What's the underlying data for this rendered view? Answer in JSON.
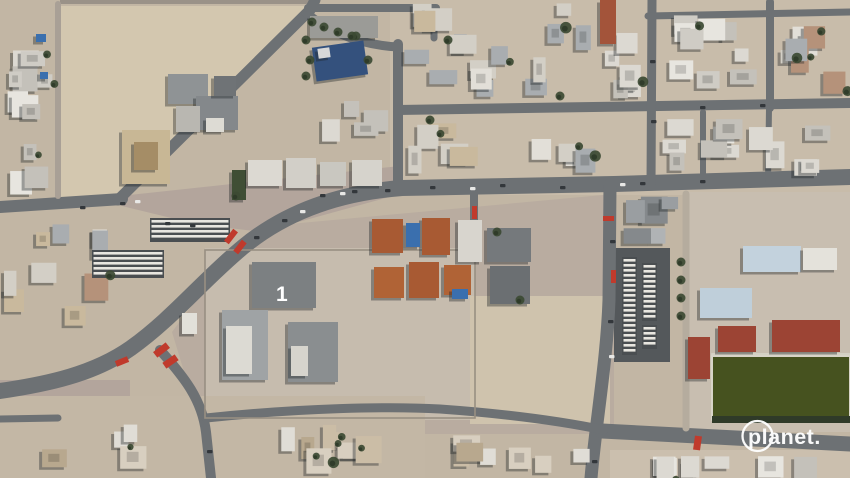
{
  "watermark": {
    "text": "planet."
  },
  "scene": {
    "labels": {
      "compound_number": "1"
    },
    "colors": {
      "base": "#c2b6a4",
      "sand_lot": "#d3c7af",
      "pink_pave": "#b3a59c",
      "pave_light": "#c6bcae",
      "road": "#6d7174",
      "asphalt": "#54585b",
      "field_green": "#46521f",
      "tree": "#3c4a33",
      "red_mark": "#c03a2c",
      "navy_roof": "#34517d",
      "pool_blue": "#3a6fae",
      "school_blue": "#c3d2dd",
      "school_red": "#9c4434",
      "white": "#ffffff"
    },
    "grounds": [
      {
        "type": "rect",
        "x": 0,
        "y": 0,
        "w": 850,
        "h": 478,
        "f": "#c2b6a4"
      },
      {
        "type": "rect",
        "x": 390,
        "y": 0,
        "w": 460,
        "h": 195,
        "f": "#c8bcaa"
      },
      {
        "type": "poly",
        "pts": [
          [
            57,
            6
          ],
          [
            308,
            6
          ],
          [
            300,
            16
          ],
          [
            118,
            197
          ],
          [
            57,
            197
          ]
        ],
        "f": "#d3c7af"
      },
      {
        "type": "poly",
        "pts": [
          [
            120,
            196
          ],
          [
            400,
            166
          ],
          [
            400,
            194
          ],
          [
            262,
            232
          ],
          [
            196,
            224
          ],
          [
            122,
            206
          ]
        ],
        "f": "#b3a59c"
      },
      {
        "type": "poly",
        "pts": [
          [
            268,
            226
          ],
          [
            614,
            194
          ],
          [
            614,
            434
          ],
          [
            203,
            434
          ],
          [
            172,
            332
          ],
          [
            228,
            258
          ]
        ],
        "f": "#b9aca0"
      },
      {
        "type": "rect",
        "x": 205,
        "y": 248,
        "w": 270,
        "h": 172,
        "f": "#c6bcae"
      },
      {
        "type": "rect",
        "x": 470,
        "y": 296,
        "w": 140,
        "h": 128,
        "f": "#cfc3ad"
      },
      {
        "type": "rect",
        "x": 688,
        "y": 192,
        "w": 162,
        "h": 240,
        "f": "#c8beb0"
      },
      {
        "type": "rect",
        "x": 614,
        "y": 248,
        "w": 56,
        "h": 114,
        "f": "#54585b"
      },
      {
        "type": "rect",
        "x": 0,
        "y": 380,
        "w": 130,
        "h": 46,
        "f": "#b3a59c"
      },
      {
        "type": "rect",
        "x": 0,
        "y": 396,
        "w": 425,
        "h": 82,
        "f": "#c3b7a5"
      },
      {
        "type": "rect",
        "x": 610,
        "y": 450,
        "w": 240,
        "h": 28,
        "f": "#cbbfae"
      },
      {
        "type": "rect",
        "x": 60,
        "y": 0,
        "w": 250,
        "h": 4,
        "f": "#9a9288"
      }
    ],
    "roads": [
      {
        "d": "M 850,177 L 614,184 L 402,188 C 335,193 283,214 243,247 C 203,280 173,318 131,348 C 94,374 48,384 0,391",
        "w": 16
      },
      {
        "d": "M 0,207 L 122,199",
        "w": 12
      },
      {
        "d": "M 118,200 L 310,10 L 315,0",
        "w": 11
      },
      {
        "d": "M 306,13 C 332,34 362,45 398,47",
        "w": 9
      },
      {
        "d": "M 308,8 L 436,8",
        "w": 8
      },
      {
        "d": "M 398,44 L 398,190",
        "w": 10
      },
      {
        "d": "M 434,8 L 434,38",
        "w": 7
      },
      {
        "d": "M 398,110 L 850,103",
        "w": 10
      },
      {
        "d": "M 652,0 L 651,186",
        "w": 9
      },
      {
        "d": "M 770,2 L 770,108",
        "w": 8
      },
      {
        "d": "M 648,16 L 850,12",
        "w": 7
      },
      {
        "d": "M 610,185 L 609,300 C 607,360 596,420 591,478",
        "w": 13
      },
      {
        "d": "M 602,431 L 850,444",
        "w": 15
      },
      {
        "d": "M 160,350 C 185,378 202,400 206,432 L 211,478",
        "w": 10
      },
      {
        "d": "M 206,418 C 300,408 390,406 440,409 C 510,414 565,422 604,430",
        "w": 9
      },
      {
        "d": "M 0,419 L 58,418",
        "w": 7
      },
      {
        "d": "M 686,194 L 686,428",
        "w": 7,
        "c": "#b5ac9e"
      },
      {
        "d": "M 703,112 L 703,180",
        "w": 6
      },
      {
        "d": "M 769,108 L 768,182",
        "w": 6
      },
      {
        "d": "M 58,4 L 58,196",
        "w": 6,
        "c": "#a9a096"
      },
      {
        "d": "M 474,192 L 474,228",
        "w": 8
      }
    ],
    "fences": [
      {
        "x": 205,
        "y": 250,
        "w": 270,
        "h": 168,
        "c": "#988f82"
      },
      {
        "x": 712,
        "y": 354,
        "w": 138,
        "h": 66,
        "c": "#d8d4c8"
      }
    ],
    "blocks": [
      {
        "x": 4,
        "y": 4,
        "w": 52,
        "h": 192,
        "n": 11,
        "pal": "white",
        "tree": 0.15
      },
      {
        "x": 2,
        "y": 214,
        "w": 110,
        "h": 112,
        "n": 9,
        "pal": "mixed",
        "tree": 0.2
      },
      {
        "x": 402,
        "y": 2,
        "w": 208,
        "h": 100,
        "n": 16,
        "pal": "mixed",
        "tree": 0.18
      },
      {
        "x": 402,
        "y": 118,
        "w": 200,
        "h": 58,
        "n": 9,
        "pal": "mixed",
        "tree": 0.15
      },
      {
        "x": 598,
        "y": 24,
        "w": 48,
        "h": 76,
        "n": 6,
        "pal": "white",
        "tree": 0.12
      },
      {
        "x": 658,
        "y": 2,
        "w": 106,
        "h": 100,
        "n": 9,
        "pal": "white",
        "tree": 0.15
      },
      {
        "x": 776,
        "y": 18,
        "w": 72,
        "h": 82,
        "n": 7,
        "pal": "mixed",
        "tree": 0.15
      },
      {
        "x": 618,
        "y": 116,
        "w": 230,
        "h": 62,
        "n": 12,
        "pal": "white",
        "tree": 0.12
      },
      {
        "x": 616,
        "y": 196,
        "w": 66,
        "h": 48,
        "n": 5,
        "pal": "gray",
        "tree": 0.1
      },
      {
        "x": 2,
        "y": 424,
        "w": 416,
        "h": 52,
        "n": 12,
        "pal": "tan",
        "tree": 0.55
      },
      {
        "x": 426,
        "y": 432,
        "w": 168,
        "h": 44,
        "n": 7,
        "pal": "tan",
        "tree": 0.35
      },
      {
        "x": 618,
        "y": 456,
        "w": 230,
        "h": 20,
        "n": 8,
        "pal": "white",
        "tree": 0.1
      },
      {
        "x": 315,
        "y": 88,
        "w": 75,
        "h": 55,
        "n": 4,
        "pal": "white",
        "tree": 0.2
      }
    ],
    "palettes": {
      "white": [
        "#e7e5df",
        "#dcd9d2",
        "#cfccc5",
        "#c4c1ba"
      ],
      "mixed": [
        "#e2dfd8",
        "#d3cfc6",
        "#c9b99d",
        "#b5927a",
        "#a9adb0"
      ],
      "gray": [
        "#9a9ea1",
        "#85898c",
        "#b0b3b5"
      ],
      "tan": [
        "#d8cfc0",
        "#cbbda6",
        "#e0ddd6",
        "#b8a88e"
      ]
    },
    "buildings": [
      {
        "x": 168,
        "y": 74,
        "w": 40,
        "h": 30,
        "f": "#8f9395"
      },
      {
        "x": 196,
        "y": 96,
        "w": 42,
        "h": 34,
        "f": "#84888b"
      },
      {
        "x": 176,
        "y": 106,
        "w": 24,
        "h": 26,
        "f": "#b9b7b1"
      },
      {
        "x": 214,
        "y": 76,
        "w": 22,
        "h": 20,
        "f": "#6f7376"
      },
      {
        "x": 206,
        "y": 118,
        "w": 18,
        "h": 14,
        "f": "#dddbd4"
      },
      {
        "x": 122,
        "y": 130,
        "w": 48,
        "h": 54,
        "f": "#c8b795"
      },
      {
        "x": 134,
        "y": 142,
        "w": 24,
        "h": 28,
        "f": "#a58d66"
      },
      {
        "x": 314,
        "y": 44,
        "w": 52,
        "h": 34,
        "f": "#34517d",
        "r": -8
      },
      {
        "x": 318,
        "y": 48,
        "w": 12,
        "h": 10,
        "f": "#d8d8d8",
        "r": -8
      },
      {
        "x": 310,
        "y": 16,
        "w": 68,
        "h": 22,
        "f": "#9b9b97"
      },
      {
        "x": 232,
        "y": 170,
        "w": 14,
        "h": 30,
        "f": "#3f4e35"
      },
      {
        "x": 248,
        "y": 160,
        "w": 34,
        "h": 26,
        "f": "#dcd9d2"
      },
      {
        "x": 286,
        "y": 158,
        "w": 30,
        "h": 30,
        "f": "#d2cfc8"
      },
      {
        "x": 320,
        "y": 162,
        "w": 26,
        "h": 24,
        "f": "#c9c7c0"
      },
      {
        "x": 352,
        "y": 160,
        "w": 30,
        "h": 26,
        "f": "#d6d3cc"
      },
      {
        "x": 36,
        "y": 34,
        "w": 10,
        "h": 8,
        "f": "#3a6fae"
      },
      {
        "x": 40,
        "y": 72,
        "w": 8,
        "h": 7,
        "f": "#3a6fae"
      },
      {
        "x": 372,
        "y": 219,
        "w": 31,
        "h": 34,
        "f": "#a85a33"
      },
      {
        "x": 422,
        "y": 218,
        "w": 28,
        "h": 37,
        "f": "#a85a33"
      },
      {
        "x": 374,
        "y": 267,
        "w": 30,
        "h": 31,
        "f": "#b06336"
      },
      {
        "x": 409,
        "y": 262,
        "w": 30,
        "h": 36,
        "f": "#a85a33"
      },
      {
        "x": 444,
        "y": 265,
        "w": 27,
        "h": 30,
        "f": "#b06336"
      },
      {
        "x": 406,
        "y": 223,
        "w": 14,
        "h": 24,
        "f": "#3a6fae"
      },
      {
        "x": 452,
        "y": 289,
        "w": 16,
        "h": 10,
        "f": "#3a6fae"
      },
      {
        "x": 458,
        "y": 220,
        "w": 24,
        "h": 42,
        "f": "#d8d5ce"
      },
      {
        "x": 487,
        "y": 228,
        "w": 44,
        "h": 34,
        "f": "#75797c"
      },
      {
        "x": 490,
        "y": 266,
        "w": 40,
        "h": 38,
        "f": "#6b6f72"
      },
      {
        "x": 252,
        "y": 262,
        "w": 64,
        "h": 46,
        "f": "#7c8082"
      },
      {
        "x": 222,
        "y": 310,
        "w": 46,
        "h": 70,
        "f": "#9fa3a5"
      },
      {
        "x": 226,
        "y": 326,
        "w": 26,
        "h": 48,
        "f": "#dcdad3"
      },
      {
        "x": 288,
        "y": 322,
        "w": 50,
        "h": 60,
        "f": "#8a8e90"
      },
      {
        "x": 291,
        "y": 346,
        "w": 17,
        "h": 30,
        "f": "#d6d4cd"
      },
      {
        "x": 182,
        "y": 313,
        "w": 15,
        "h": 21,
        "f": "#e2e0d9"
      },
      {
        "x": 743,
        "y": 246,
        "w": 58,
        "h": 26,
        "f": "#c3d2dd"
      },
      {
        "x": 803,
        "y": 248,
        "w": 34,
        "h": 22,
        "f": "#e4e2db"
      },
      {
        "x": 700,
        "y": 288,
        "w": 52,
        "h": 30,
        "f": "#bfcfda"
      },
      {
        "x": 718,
        "y": 326,
        "w": 38,
        "h": 26,
        "f": "#9c4434"
      },
      {
        "x": 772,
        "y": 320,
        "w": 68,
        "h": 32,
        "f": "#9c4434"
      },
      {
        "x": 688,
        "y": 337,
        "w": 22,
        "h": 42,
        "f": "#9c4434"
      },
      {
        "x": 600,
        "y": 0,
        "w": 16,
        "h": 44,
        "f": "#a3543a"
      }
    ],
    "field": {
      "x": 712,
      "y": 356,
      "w": 138,
      "h": 62,
      "f": "#46521f",
      "treeline": {
        "x": 712,
        "y": 416,
        "w": 138,
        "h": 7,
        "f": "#2f3a28"
      }
    },
    "stripes": [
      {
        "x": 622,
        "y": 257,
        "w": 15,
        "h": 98
      },
      {
        "x": 642,
        "y": 263,
        "w": 15,
        "h": 58
      },
      {
        "x": 642,
        "y": 325,
        "w": 15,
        "h": 24
      },
      {
        "x": 92,
        "y": 250,
        "w": 72,
        "h": 28
      },
      {
        "x": 150,
        "y": 218,
        "w": 80,
        "h": 24
      }
    ],
    "cars": [
      [
        320,
        194
      ],
      [
        352,
        190
      ],
      [
        385,
        189
      ],
      [
        254,
        236
      ],
      [
        282,
        219
      ],
      [
        430,
        186
      ],
      [
        500,
        184
      ],
      [
        560,
        186
      ],
      [
        640,
        182
      ],
      [
        700,
        180
      ],
      [
        120,
        202
      ],
      [
        80,
        206
      ],
      [
        610,
        240
      ],
      [
        608,
        320
      ],
      [
        650,
        60
      ],
      [
        651,
        120
      ],
      [
        700,
        106
      ],
      [
        760,
        104
      ],
      [
        207,
        450
      ],
      [
        592,
        460
      ],
      [
        165,
        222
      ],
      [
        190,
        224
      ]
    ],
    "cars_white": [
      [
        340,
        192
      ],
      [
        470,
        187
      ],
      [
        620,
        183
      ],
      [
        135,
        200
      ],
      [
        609,
        355
      ],
      [
        300,
        210
      ]
    ],
    "red_marks": [
      [
        228,
        229,
        6,
        15,
        38
      ],
      [
        237,
        240,
        6,
        14,
        38
      ],
      [
        158,
        342,
        7,
        16,
        52
      ],
      [
        167,
        354,
        7,
        15,
        55
      ],
      [
        119,
        355,
        6,
        13,
        68
      ],
      [
        611,
        270,
        5,
        13,
        0
      ],
      [
        603,
        216,
        11,
        5,
        0
      ],
      [
        694,
        436,
        7,
        14,
        8
      ],
      [
        472,
        206,
        5,
        13,
        0
      ]
    ],
    "trees": [
      [
        306,
        40
      ],
      [
        310,
        60
      ],
      [
        356,
        36
      ],
      [
        368,
        60
      ],
      [
        306,
        76
      ],
      [
        312,
        22
      ],
      [
        324,
        27
      ],
      [
        338,
        32
      ],
      [
        352,
        36
      ],
      [
        681,
        262
      ],
      [
        681,
        280
      ],
      [
        681,
        298
      ],
      [
        681,
        316
      ],
      [
        497,
        232
      ],
      [
        520,
        300
      ],
      [
        236,
        196
      ],
      [
        448,
        40
      ],
      [
        560,
        96
      ],
      [
        430,
        120
      ]
    ],
    "logo": {
      "cx": 757.5,
      "cy": 436,
      "r": 15,
      "text_x": 748,
      "text_y": 444,
      "font_size": 21.5
    }
  }
}
